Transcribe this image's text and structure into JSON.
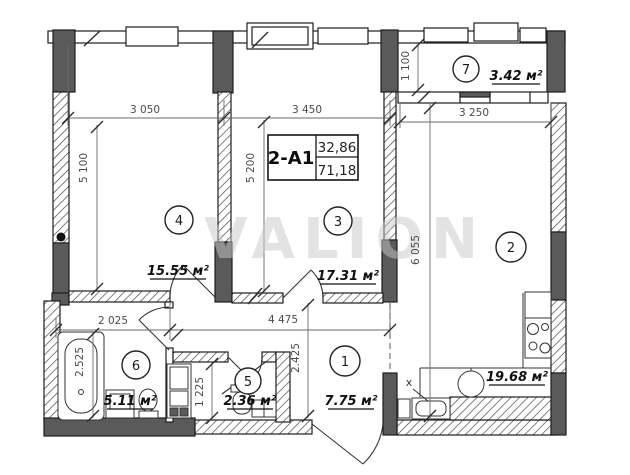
{
  "watermark": "VALION",
  "title_block": {
    "code": "2-A1",
    "living_area": "32,86",
    "total_area": "71,18"
  },
  "rooms": [
    {
      "number": "1",
      "area": "7.75 м²"
    },
    {
      "number": "2",
      "area": "19.68 м²"
    },
    {
      "number": "3",
      "area": "17.31 м²"
    },
    {
      "number": "4",
      "area": "15.55 м²"
    },
    {
      "number": "5",
      "area": "2.36 м²"
    },
    {
      "number": "6",
      "area": "5.11 м²"
    },
    {
      "number": "7",
      "area": "3.42 м²"
    }
  ],
  "dimensions": {
    "room4_width": "3 050",
    "room3_width": "3 450",
    "balcony_depth": "1 100",
    "balcony_width": "3 250",
    "room4_height": "5 100",
    "room3_height": "5 200",
    "room2_height": "6 055",
    "bathroom_width": "2 025",
    "hall_width": "4 475",
    "bathroom_height": "2.525",
    "wc_height": "1 225",
    "hall_height": "2.425",
    "marker_x": "x"
  }
}
